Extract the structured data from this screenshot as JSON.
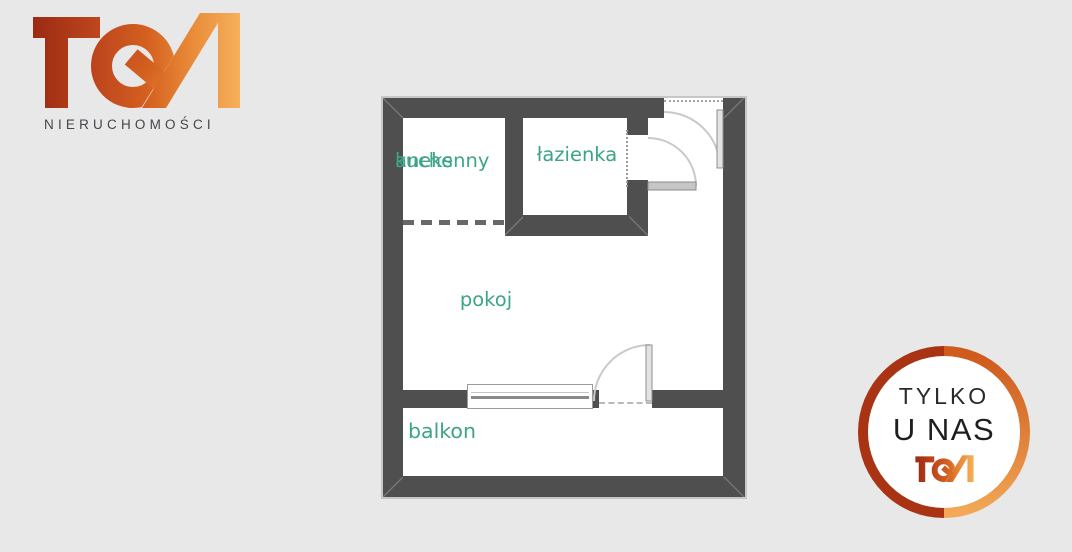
{
  "brand": {
    "name": "TGN",
    "wordmark": "NIERUCHOMOŚCI",
    "gradient": [
      "#9b2a12",
      "#c04a1e",
      "#d4601f",
      "#f5b05b"
    ]
  },
  "floorplan": {
    "wall_color": "#4f4f4f",
    "label_color": "#3ca487",
    "rooms": {
      "kitchen": {
        "line1": "aneks",
        "line2": "kuchenny"
      },
      "bathroom": {
        "label": "łazienka"
      },
      "living": {
        "label": "pokoj"
      },
      "balcony": {
        "label": "balkon"
      }
    }
  },
  "badge": {
    "line1": "TYLKO",
    "line2": "U NAS",
    "brand": "TGN",
    "ring_left_color": "#a93413",
    "ring_right_color": "#cf5c1d"
  }
}
